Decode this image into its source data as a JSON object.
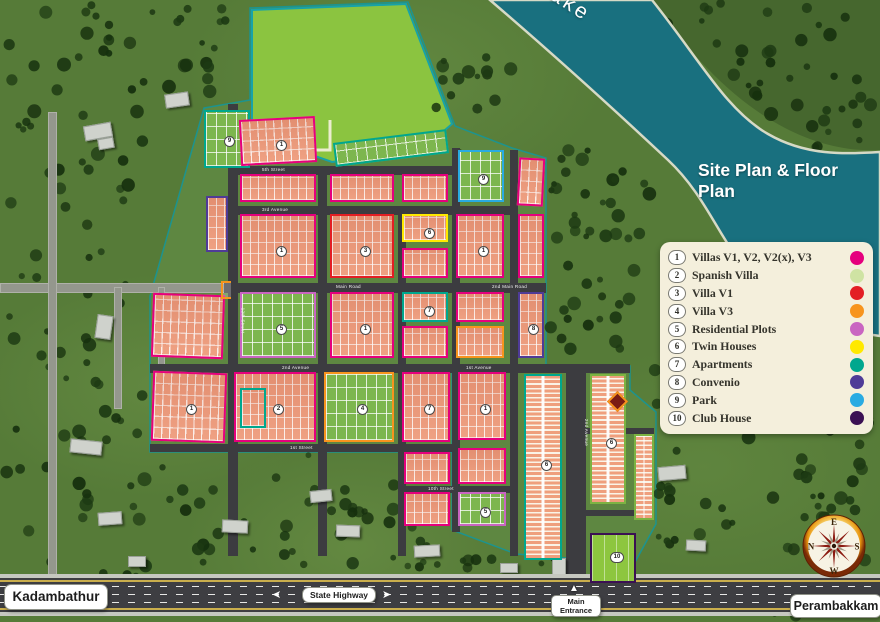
{
  "title": "Site Plan & Floor Plan",
  "lake_label": "Lake",
  "places": {
    "left": "Kadambathur",
    "right": "Perambakkam",
    "highway": "State Highway",
    "entrance": "Main Entrance"
  },
  "compass_letters": {
    "top": "E",
    "right": "S",
    "bottom": "W",
    "left": "N"
  },
  "colors": {
    "magenta": "#e5007d",
    "spanish": "#cfe3a3",
    "red": "#e31e24",
    "orange": "#f7941e",
    "violet": "#c965c1",
    "yellow": "#ffe900",
    "teal": "#00a78e",
    "purple": "#4f3b97",
    "park_blue": "#29abe2",
    "clubhouse": "#3b1053",
    "green": "#7cb342"
  },
  "legend": {
    "items": [
      {
        "num": "1",
        "label": "Villas V1, V2, V2(x), V3",
        "color": "magenta"
      },
      {
        "num": "2",
        "label": "Spanish Villa",
        "color": "spanish"
      },
      {
        "num": "3",
        "label": "Villa V1",
        "color": "red"
      },
      {
        "num": "4",
        "label": "Villa V3",
        "color": "orange"
      },
      {
        "num": "5",
        "label": "Residential Plots",
        "color": "violet"
      },
      {
        "num": "6",
        "label": "Twin Houses",
        "color": "yellow"
      },
      {
        "num": "7",
        "label": "Apartments",
        "color": "teal"
      },
      {
        "num": "8",
        "label": "Convenio",
        "color": "purple"
      },
      {
        "num": "9",
        "label": "Park",
        "color": "park_blue"
      },
      {
        "num": "10",
        "label": "Club House",
        "color": "clubhouse"
      }
    ]
  },
  "map": {
    "roads": [
      {
        "x": 0,
        "y": 283,
        "w": 228,
        "h": 10,
        "c": "ext"
      },
      {
        "x": 48,
        "y": 112,
        "w": 9,
        "h": 466,
        "c": "ext"
      },
      {
        "x": 114,
        "y": 287,
        "w": 8,
        "h": 122,
        "c": "ext"
      },
      {
        "x": 158,
        "y": 287,
        "w": 7,
        "h": 108,
        "c": "ext"
      },
      {
        "x": 228,
        "y": 104,
        "w": 10,
        "h": 452,
        "c": "plan"
      },
      {
        "x": 318,
        "y": 166,
        "w": 9,
        "h": 390,
        "c": "plan"
      },
      {
        "x": 398,
        "y": 208,
        "w": 8,
        "h": 348,
        "c": "plan"
      },
      {
        "x": 452,
        "y": 148,
        "w": 8,
        "h": 384,
        "c": "plan"
      },
      {
        "x": 510,
        "y": 150,
        "w": 8,
        "h": 406,
        "c": "plan"
      },
      {
        "x": 566,
        "y": 364,
        "w": 20,
        "h": 214,
        "c": "plan"
      },
      {
        "x": 228,
        "y": 166,
        "w": 228,
        "h": 9,
        "c": "plan"
      },
      {
        "x": 228,
        "y": 206,
        "w": 290,
        "h": 9,
        "c": "plan"
      },
      {
        "x": 224,
        "y": 283,
        "w": 322,
        "h": 10,
        "c": "plan"
      },
      {
        "x": 150,
        "y": 364,
        "w": 480,
        "h": 9,
        "c": "plan"
      },
      {
        "x": 150,
        "y": 444,
        "w": 310,
        "h": 8,
        "c": "plan"
      },
      {
        "x": 398,
        "y": 486,
        "w": 120,
        "h": 7,
        "c": "plan"
      },
      {
        "x": 586,
        "y": 428,
        "w": 68,
        "h": 6,
        "c": "plan"
      },
      {
        "x": 586,
        "y": 510,
        "w": 68,
        "h": 6,
        "c": "plan"
      }
    ],
    "blocks": [
      {
        "x": 204,
        "y": 110,
        "w": 46,
        "h": 58,
        "b": "teal",
        "f": "g"
      },
      {
        "x": 240,
        "y": 118,
        "w": 76,
        "h": 46,
        "b": "magenta",
        "f": "h",
        "r": -3
      },
      {
        "x": 334,
        "y": 136,
        "w": 114,
        "h": 24,
        "b": "teal",
        "f": "g",
        "r": -7
      },
      {
        "x": 458,
        "y": 150,
        "w": 46,
        "h": 52,
        "b": "park_blue",
        "f": "g"
      },
      {
        "x": 206,
        "y": 196,
        "w": 22,
        "h": 56,
        "b": "purple",
        "f": "h"
      },
      {
        "x": 240,
        "y": 174,
        "w": 76,
        "h": 28,
        "b": "magenta",
        "f": "h"
      },
      {
        "x": 330,
        "y": 174,
        "w": 64,
        "h": 28,
        "b": "magenta",
        "f": "h"
      },
      {
        "x": 402,
        "y": 174,
        "w": 46,
        "h": 28,
        "b": "magenta",
        "f": "h"
      },
      {
        "x": 518,
        "y": 158,
        "w": 26,
        "h": 48,
        "b": "magenta",
        "f": "h",
        "r": 3
      },
      {
        "x": 240,
        "y": 214,
        "w": 76,
        "h": 64,
        "b": "magenta",
        "f": "h"
      },
      {
        "x": 330,
        "y": 214,
        "w": 64,
        "h": 64,
        "b": "red",
        "f": "h"
      },
      {
        "x": 402,
        "y": 214,
        "w": 46,
        "h": 28,
        "b": "yellow",
        "f": "h"
      },
      {
        "x": 402,
        "y": 248,
        "w": 46,
        "h": 30,
        "b": "magenta",
        "f": "h"
      },
      {
        "x": 456,
        "y": 214,
        "w": 48,
        "h": 64,
        "b": "magenta",
        "f": "h"
      },
      {
        "x": 518,
        "y": 214,
        "w": 26,
        "h": 64,
        "b": "magenta",
        "f": "h"
      },
      {
        "x": 152,
        "y": 294,
        "w": 72,
        "h": 64,
        "b": "magenta",
        "f": "h",
        "r": 2
      },
      {
        "x": 240,
        "y": 292,
        "w": 76,
        "h": 66,
        "b": "violet",
        "f": "g"
      },
      {
        "x": 330,
        "y": 292,
        "w": 64,
        "h": 66,
        "b": "magenta",
        "f": "h"
      },
      {
        "x": 402,
        "y": 292,
        "w": 46,
        "h": 30,
        "b": "teal",
        "f": "h"
      },
      {
        "x": 402,
        "y": 326,
        "w": 46,
        "h": 32,
        "b": "magenta",
        "f": "h"
      },
      {
        "x": 456,
        "y": 292,
        "w": 48,
        "h": 30,
        "b": "magenta",
        "f": "h"
      },
      {
        "x": 456,
        "y": 326,
        "w": 48,
        "h": 32,
        "b": "orange",
        "f": "h"
      },
      {
        "x": 518,
        "y": 292,
        "w": 26,
        "h": 66,
        "b": "purple",
        "f": "h"
      },
      {
        "x": 152,
        "y": 372,
        "w": 74,
        "h": 70,
        "b": "magenta",
        "f": "h",
        "r": 2
      },
      {
        "x": 234,
        "y": 372,
        "w": 82,
        "h": 70,
        "b": "magenta",
        "f": "h"
      },
      {
        "x": 240,
        "y": 388,
        "w": 26,
        "h": 40,
        "b": "teal",
        "f": "h"
      },
      {
        "x": 324,
        "y": 372,
        "w": 70,
        "h": 70,
        "b": "orange",
        "f": "g"
      },
      {
        "x": 402,
        "y": 372,
        "w": 48,
        "h": 70,
        "b": "magenta",
        "f": "h"
      },
      {
        "x": 458,
        "y": 372,
        "w": 48,
        "h": 68,
        "b": "magenta",
        "f": "h"
      },
      {
        "x": 458,
        "y": 448,
        "w": 48,
        "h": 36,
        "b": "magenta",
        "f": "h"
      },
      {
        "x": 458,
        "y": 492,
        "w": 48,
        "h": 34,
        "b": "violet",
        "f": "g"
      },
      {
        "x": 404,
        "y": 452,
        "w": 46,
        "h": 32,
        "b": "magenta",
        "f": "h"
      },
      {
        "x": 404,
        "y": 492,
        "w": 46,
        "h": 34,
        "b": "magenta",
        "f": "h"
      },
      {
        "x": 524,
        "y": 374,
        "w": 38,
        "h": 186,
        "b": "teal",
        "f": "s"
      },
      {
        "x": 590,
        "y": 374,
        "w": 36,
        "h": 130,
        "b": "green",
        "f": "s"
      },
      {
        "x": 634,
        "y": 434,
        "w": 20,
        "h": 86,
        "b": "green",
        "f": "s"
      },
      {
        "x": 590,
        "y": 533,
        "w": 46,
        "h": 50,
        "b": "clubhouse",
        "f": "c"
      },
      {
        "x": 610,
        "y": 394,
        "w": 15,
        "h": 15,
        "b": "orange",
        "f": "rb",
        "r": 45
      }
    ],
    "markers": [
      {
        "n": "9",
        "x": 224,
        "y": 136
      },
      {
        "n": "1",
        "x": 276,
        "y": 140
      },
      {
        "n": "9",
        "x": 478,
        "y": 174
      },
      {
        "n": "1",
        "x": 276,
        "y": 246
      },
      {
        "n": "3",
        "x": 360,
        "y": 246
      },
      {
        "n": "6",
        "x": 424,
        "y": 228
      },
      {
        "n": "1",
        "x": 478,
        "y": 246
      },
      {
        "n": "5",
        "x": 276,
        "y": 324
      },
      {
        "n": "1",
        "x": 360,
        "y": 324
      },
      {
        "n": "7",
        "x": 424,
        "y": 306
      },
      {
        "n": "8",
        "x": 528,
        "y": 324
      },
      {
        "n": "1",
        "x": 186,
        "y": 404
      },
      {
        "n": "2",
        "x": 273,
        "y": 404
      },
      {
        "n": "4",
        "x": 357,
        "y": 404
      },
      {
        "n": "7",
        "x": 424,
        "y": 404
      },
      {
        "n": "1",
        "x": 480,
        "y": 404
      },
      {
        "n": "6",
        "x": 541,
        "y": 460
      },
      {
        "n": "6",
        "x": 606,
        "y": 438
      },
      {
        "n": "5",
        "x": 480,
        "y": 507
      },
      {
        "n": "10",
        "x": 610,
        "y": 552
      }
    ],
    "road_labels": [
      {
        "t": "5th Street",
        "x": 262,
        "y": 167,
        "rot": 0
      },
      {
        "t": "3rd Avenue",
        "x": 262,
        "y": 207,
        "rot": 0
      },
      {
        "t": "Main Road",
        "x": 336,
        "y": 284,
        "rot": 0
      },
      {
        "t": "2nd Main Road",
        "x": 492,
        "y": 284,
        "rot": 0
      },
      {
        "t": "2nd Avenue",
        "x": 282,
        "y": 365,
        "rot": 0
      },
      {
        "t": "1st Avenue",
        "x": 466,
        "y": 365,
        "rot": 0
      },
      {
        "t": "1st Street",
        "x": 290,
        "y": 445,
        "rot": 0
      },
      {
        "t": "10th Street",
        "x": 428,
        "y": 486,
        "rot": 0
      },
      {
        "t": "12th Street",
        "x": 230,
        "y": 318,
        "rot": 90
      },
      {
        "t": "2nd Avenue",
        "x": 573,
        "y": 430,
        "rot": 90
      }
    ],
    "buildings": [
      {
        "x": 84,
        "y": 124,
        "w": 26,
        "h": 13,
        "r": -10
      },
      {
        "x": 98,
        "y": 138,
        "w": 14,
        "h": 9,
        "r": -10
      },
      {
        "x": 165,
        "y": 93,
        "w": 22,
        "h": 12,
        "r": -8
      },
      {
        "x": 96,
        "y": 315,
        "w": 14,
        "h": 22,
        "r": 8
      },
      {
        "x": 70,
        "y": 440,
        "w": 30,
        "h": 12,
        "r": 6
      },
      {
        "x": 98,
        "y": 512,
        "w": 22,
        "h": 11,
        "r": -4
      },
      {
        "x": 128,
        "y": 556,
        "w": 16,
        "h": 9,
        "r": 0
      },
      {
        "x": 222,
        "y": 520,
        "w": 24,
        "h": 11,
        "r": 3
      },
      {
        "x": 310,
        "y": 490,
        "w": 20,
        "h": 10,
        "r": -6
      },
      {
        "x": 336,
        "y": 525,
        "w": 22,
        "h": 10,
        "r": 2
      },
      {
        "x": 414,
        "y": 545,
        "w": 24,
        "h": 10,
        "r": -3
      },
      {
        "x": 500,
        "y": 563,
        "w": 16,
        "h": 8,
        "r": 0
      },
      {
        "x": 658,
        "y": 466,
        "w": 26,
        "h": 12,
        "r": -5
      },
      {
        "x": 686,
        "y": 540,
        "w": 18,
        "h": 9,
        "r": 3
      },
      {
        "x": 552,
        "y": 558,
        "w": 12,
        "h": 16,
        "r": 0
      },
      {
        "x": 600,
        "y": 548,
        "w": 22,
        "h": 24,
        "r": 0
      }
    ]
  }
}
